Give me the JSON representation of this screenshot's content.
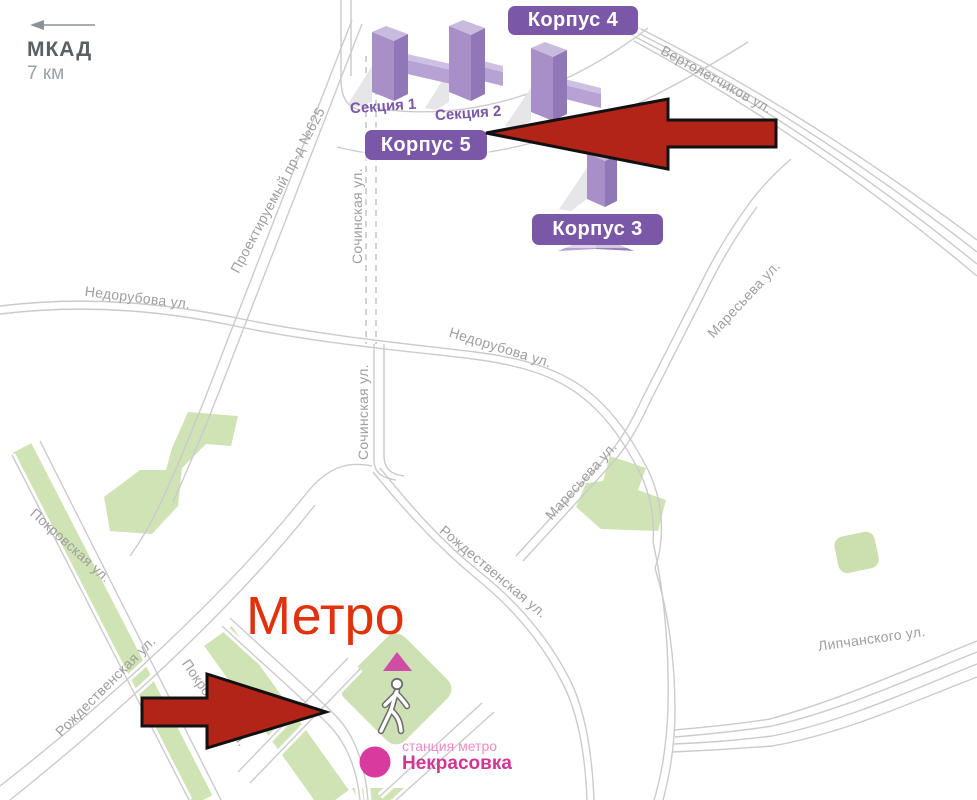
{
  "scale_indicator": {
    "road": "МКАД",
    "distance": "7 км"
  },
  "building_badges": [
    {
      "label": "Корпус 4"
    },
    {
      "label": "Корпус 5"
    },
    {
      "label": "Корпус 3"
    }
  ],
  "section_labels": [
    {
      "label": "Секция 1"
    },
    {
      "label": "Секция 2"
    }
  ],
  "street_labels": [
    {
      "name": "Вертолетчиков ул."
    },
    {
      "name": "Проектируемый пр-д №625"
    },
    {
      "name": "Сочинская ул."
    },
    {
      "name": "Сочинская ул."
    },
    {
      "name": "Недорубова ул."
    },
    {
      "name": "Недорубова ул."
    },
    {
      "name": "Маресьева ул."
    },
    {
      "name": "Маресьева ул."
    },
    {
      "name": "Рождественская ул."
    },
    {
      "name": "Покровская ул."
    },
    {
      "name": "Рождественская ул."
    },
    {
      "name": "Липчанского ул."
    },
    {
      "name": "Покровская ул."
    }
  ],
  "metro": {
    "headline": "Метро",
    "station_caption": "станция метро",
    "station_name": "Некрасовка"
  },
  "colors": {
    "badge_purple": "#7a58a7",
    "building_face": "#a88fc7",
    "building_top": "#c9bbde",
    "building_side": "#9077b8",
    "arrow_red": "#b22417",
    "metro_headline_red": "#e0330d",
    "metro_pink": "#d53492",
    "station_dot_pink": "#d83a9d",
    "park_green": "#cfe3b4",
    "road_gray": "#cbcbcb"
  }
}
